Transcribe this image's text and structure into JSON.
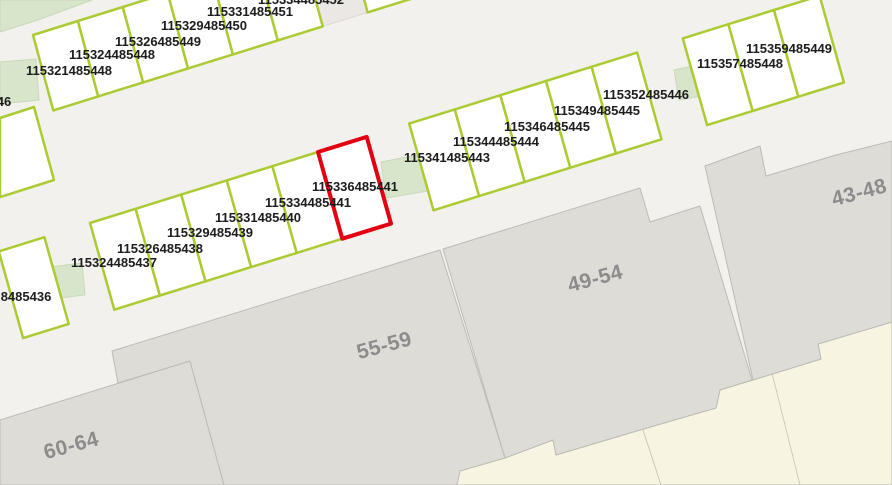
{
  "app": {
    "title": "Cadastral parcel map view"
  },
  "colors": {
    "road": "#f3f1ee",
    "parcel_fill": "#ffffff",
    "parcel_stroke": "#abcb33",
    "selected_fill": "#f7caca",
    "selected_stroke": "#e30010",
    "building_fill": "#dedcd7",
    "building_stroke": "#bdbbb6",
    "garden_fill": "#f7f5e2",
    "garden_line": "#ccc9ba",
    "patch_fill": "#d7e5ca",
    "patch_stroke": "#c8d9b8",
    "gap_fill": "#eae7e4",
    "gap_stroke": "#dcd9d5",
    "label_color": "#1c1c1c",
    "building_label_color": "#8c8c8c"
  },
  "map": {
    "width": 892,
    "height": 485,
    "selected_parcel_id": "115336485441",
    "garden_area": {
      "name": "garden-area",
      "points": [
        [
          455,
          485
        ],
        [
          458,
          470
        ],
        [
          505,
          458
        ],
        [
          553,
          440
        ],
        [
          556,
          455
        ],
        [
          640,
          430
        ],
        [
          716,
          408
        ],
        [
          720,
          390
        ],
        [
          753,
          380
        ],
        [
          821,
          359
        ],
        [
          818,
          344
        ],
        [
          892,
          322
        ],
        [
          892,
          485
        ]
      ]
    },
    "garden_lines": [
      {
        "name": "garden-boundary-line",
        "points": [
          [
            643,
            430
          ],
          [
            661,
            485
          ]
        ]
      },
      {
        "name": "garden-boundary-line",
        "points": [
          [
            772,
            373
          ],
          [
            800,
            485
          ]
        ]
      }
    ],
    "buildings": [
      {
        "label": "60-64",
        "points": [
          [
            0,
            420
          ],
          [
            190,
            361
          ],
          [
            224,
            485
          ],
          [
            0,
            485
          ]
        ],
        "label_x": 73,
        "label_y": 452,
        "rotation": -15
      },
      {
        "label": "55-59",
        "points": [
          [
            112,
            351
          ],
          [
            440,
            250
          ],
          [
            505,
            458
          ],
          [
            460,
            471
          ],
          [
            457,
            485
          ],
          [
            224,
            485
          ],
          [
            190,
            361
          ],
          [
            118,
            383
          ]
        ],
        "label_x": 386,
        "label_y": 352,
        "rotation": -15
      },
      {
        "label": "49-54",
        "points": [
          [
            443,
            249
          ],
          [
            640,
            188
          ],
          [
            650,
            222
          ],
          [
            700,
            206
          ],
          [
            752,
            380
          ],
          [
            720,
            390
          ],
          [
            716,
            408
          ],
          [
            640,
            430
          ],
          [
            556,
            455
          ],
          [
            553,
            440
          ],
          [
            505,
            458
          ]
        ],
        "label_x": 597,
        "label_y": 285,
        "rotation": -15
      },
      {
        "label": "43-48",
        "points": [
          [
            705,
            166
          ],
          [
            760,
            146
          ],
          [
            766,
            176
          ],
          [
            836,
            155
          ],
          [
            892,
            141
          ],
          [
            892,
            322
          ],
          [
            818,
            344
          ],
          [
            821,
            359
          ],
          [
            753,
            380
          ]
        ],
        "label_x": 861,
        "label_y": 199,
        "rotation": -15
      }
    ],
    "gap_parcels": [
      {
        "name": "gap-parcel",
        "points": [
          [
            302.4,
            -49
          ],
          [
            347.3,
            -63
          ],
          [
            367.6,
            12.4
          ],
          [
            322.7,
            26.4
          ]
        ]
      }
    ],
    "green_patches": [
      {
        "name": "vegetation-patch",
        "points": [
          [
            0,
            0
          ],
          [
            92,
            0
          ],
          [
            38,
            20
          ],
          [
            0,
            32
          ]
        ]
      },
      {
        "name": "vegetation-patch",
        "points": [
          [
            0,
            62
          ],
          [
            36,
            59
          ],
          [
            39,
            100
          ],
          [
            0,
            104
          ]
        ]
      },
      {
        "name": "vegetation-patch",
        "points": [
          [
            42,
            268
          ],
          [
            82,
            263
          ],
          [
            85,
            295
          ],
          [
            45,
            300
          ]
        ]
      },
      {
        "name": "vegetation-patch",
        "points": [
          [
            381,
            162
          ],
          [
            423,
            154
          ],
          [
            428,
            191
          ],
          [
            386,
            198
          ]
        ]
      },
      {
        "name": "vegetation-patch",
        "points": [
          [
            674,
            70
          ],
          [
            713,
            62
          ],
          [
            718,
            93
          ],
          [
            679,
            100
          ]
        ]
      }
    ],
    "parcels": [
      {
        "id": "46",
        "points": [
          [
            0,
            118
          ],
          [
            34,
            107
          ],
          [
            54,
            180
          ],
          [
            0,
            197
          ]
        ]
      },
      {
        "id": "115321485448",
        "points": [
          [
            33,
            35
          ],
          [
            77.9,
            21
          ],
          [
            98.2,
            96.4
          ],
          [
            53.3,
            110.4
          ]
        ]
      },
      {
        "id": "115324485448",
        "points": [
          [
            77.9,
            21
          ],
          [
            122.8,
            7
          ],
          [
            143.1,
            82.4
          ],
          [
            98.2,
            96.4
          ]
        ]
      },
      {
        "id": "115326485449",
        "points": [
          [
            122.8,
            7
          ],
          [
            167.7,
            -7
          ],
          [
            188,
            68.4
          ],
          [
            143.1,
            82.4
          ]
        ]
      },
      {
        "id": "115329485450",
        "points": [
          [
            167.7,
            -7
          ],
          [
            212.6,
            -21
          ],
          [
            232.9,
            54.4
          ],
          [
            188,
            68.4
          ]
        ]
      },
      {
        "id": "115331485451",
        "points": [
          [
            212.6,
            -21
          ],
          [
            257.5,
            -35
          ],
          [
            277.8,
            40.4
          ],
          [
            232.9,
            54.4
          ]
        ]
      },
      {
        "id": "115334485452",
        "points": [
          [
            257.5,
            -35
          ],
          [
            302.4,
            -49
          ],
          [
            322.7,
            26.4
          ],
          [
            277.8,
            40.4
          ]
        ]
      },
      {
        "id": "",
        "points": [
          [
            347.3,
            -63
          ],
          [
            392.2,
            -77
          ],
          [
            412.5,
            -1.6
          ],
          [
            367.6,
            12.4
          ]
        ]
      },
      {
        "id": "",
        "points": [
          [
            -1.2,
            251.4
          ],
          [
            44.4,
            237.2
          ],
          [
            68.7,
            323.9
          ],
          [
            23.1,
            338.1
          ]
        ]
      },
      {
        "id": "8485436",
        "points": [
          [
            -1.2,
            251.4
          ],
          [
            44.4,
            237.2
          ],
          [
            68.7,
            323.9
          ],
          [
            23.1,
            338.1
          ]
        ],
        "skip_shape": true
      },
      {
        "id": "115324485437",
        "points": [
          [
            90,
            223
          ],
          [
            135.6,
            208.8
          ],
          [
            159.9,
            295.5
          ],
          [
            114.3,
            309.7
          ]
        ]
      },
      {
        "id": "115326485438",
        "points": [
          [
            135.6,
            208.8
          ],
          [
            181.2,
            194.6
          ],
          [
            205.5,
            281.3
          ],
          [
            159.9,
            295.5
          ]
        ]
      },
      {
        "id": "115329485439",
        "points": [
          [
            181.2,
            194.6
          ],
          [
            226.8,
            180.4
          ],
          [
            251.1,
            267.1
          ],
          [
            205.5,
            281.3
          ]
        ]
      },
      {
        "id": "115331485440",
        "points": [
          [
            226.8,
            180.4
          ],
          [
            272.4,
            166.2
          ],
          [
            296.7,
            252.9
          ],
          [
            251.1,
            267.1
          ]
        ]
      },
      {
        "id": "115334485441",
        "points": [
          [
            272.4,
            166.2
          ],
          [
            318,
            152
          ],
          [
            342.3,
            238.7
          ],
          [
            296.7,
            252.9
          ]
        ]
      },
      {
        "id": "115336485441",
        "points": [
          [
            318,
            152
          ],
          [
            366.7,
            136.9
          ],
          [
            391,
            223.6
          ],
          [
            342.3,
            238.7
          ]
        ],
        "selected": true
      },
      {
        "id": "115341485443",
        "points": [
          [
            409.2,
            123.6
          ],
          [
            454.8,
            109.4
          ],
          [
            479.1,
            196.1
          ],
          [
            433.5,
            210.3
          ]
        ]
      },
      {
        "id": "115344485444",
        "points": [
          [
            454.8,
            109.4
          ],
          [
            500.4,
            95.2
          ],
          [
            524.7,
            181.9
          ],
          [
            479.1,
            196.1
          ]
        ]
      },
      {
        "id": "115346485445",
        "points": [
          [
            500.4,
            95.2
          ],
          [
            546,
            81
          ],
          [
            570.3,
            167.7
          ],
          [
            524.7,
            181.9
          ]
        ]
      },
      {
        "id": "115349485445",
        "points": [
          [
            546,
            81
          ],
          [
            591.6,
            66.8
          ],
          [
            615.9,
            153.5
          ],
          [
            570.3,
            167.7
          ]
        ]
      },
      {
        "id": "115352485446",
        "points": [
          [
            591.6,
            66.8
          ],
          [
            637.2,
            52.6
          ],
          [
            661.5,
            139.3
          ],
          [
            615.9,
            153.5
          ]
        ]
      },
      {
        "id": "115357485448",
        "points": [
          [
            682.8,
            38.4
          ],
          [
            728.4,
            24.2
          ],
          [
            752.7,
            110.9
          ],
          [
            707.1,
            125.1
          ]
        ]
      },
      {
        "id": "115359485449",
        "points": [
          [
            728.4,
            24.2
          ],
          [
            774,
            10
          ],
          [
            798.3,
            96.7
          ],
          [
            752.7,
            110.9
          ]
        ]
      },
      {
        "id": "",
        "points": [
          [
            774,
            10
          ],
          [
            819.6,
            -4.2
          ],
          [
            843.9,
            82.5
          ],
          [
            798.3,
            96.7
          ]
        ]
      }
    ],
    "parcel_labels": [
      {
        "text": "46",
        "x": 4,
        "y": 106
      },
      {
        "text": "115321485448",
        "x": 69,
        "y": 75
      },
      {
        "text": "115324485448",
        "x": 112,
        "y": 59
      },
      {
        "text": "115326485449",
        "x": 158,
        "y": 46
      },
      {
        "text": "115329485450",
        "x": 204,
        "y": 30
      },
      {
        "text": "115331485451",
        "x": 250,
        "y": 16
      },
      {
        "text": "115334485452",
        "x": 301,
        "y": 4
      },
      {
        "text": "8485436",
        "x": 26,
        "y": 301
      },
      {
        "text": "115324485437",
        "x": 114,
        "y": 267
      },
      {
        "text": "115326485438",
        "x": 160,
        "y": 253
      },
      {
        "text": "115329485439",
        "x": 210,
        "y": 237
      },
      {
        "text": "115331485440",
        "x": 258,
        "y": 222
      },
      {
        "text": "115334485441",
        "x": 308,
        "y": 207
      },
      {
        "text": "115336485441",
        "x": 355,
        "y": 191
      },
      {
        "text": "115341485443",
        "x": 447,
        "y": 162
      },
      {
        "text": "115344485444",
        "x": 496,
        "y": 146
      },
      {
        "text": "115346485445",
        "x": 547,
        "y": 131
      },
      {
        "text": "115349485445",
        "x": 597,
        "y": 115
      },
      {
        "text": "115352485446",
        "x": 646,
        "y": 99
      },
      {
        "text": "115357485448",
        "x": 740,
        "y": 68
      },
      {
        "text": "115359485449",
        "x": 789,
        "y": 53
      }
    ]
  }
}
